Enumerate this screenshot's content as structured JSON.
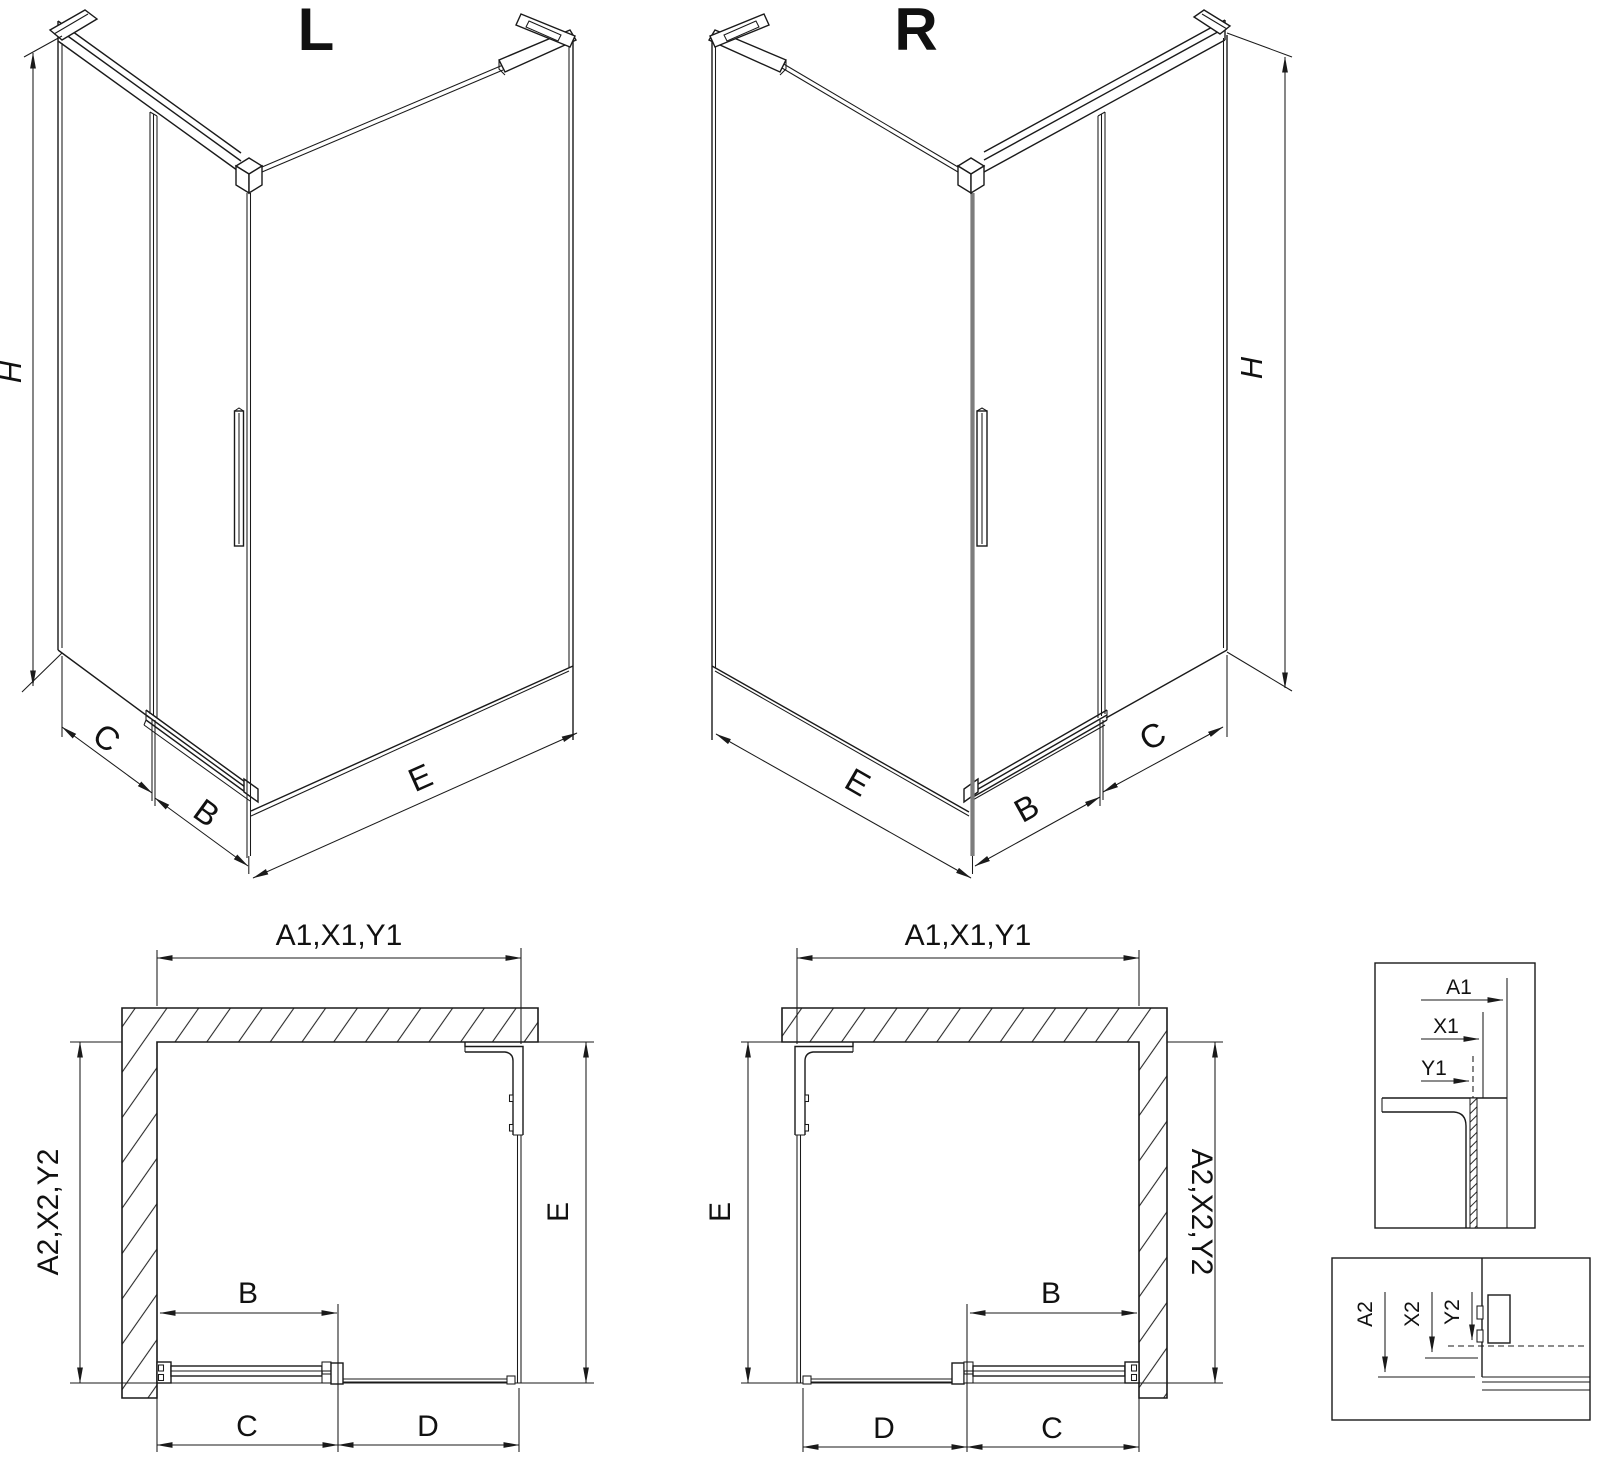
{
  "colors": {
    "line": "#1a1a1a",
    "corner_gray": "#7d7d7d",
    "background": "#ffffff"
  },
  "iso_left": {
    "label": "L",
    "dim_h": "H",
    "dim_c": "C",
    "dim_b": "B",
    "dim_e": "E"
  },
  "iso_right": {
    "label": "R",
    "dim_h": "H",
    "dim_e": "E",
    "dim_b": "B",
    "dim_c": "C"
  },
  "plan_left": {
    "dim_top": "A1,X1,Y1",
    "dim_left": "A2,X2,Y2",
    "dim_right": "E",
    "dim_b": "B",
    "dim_c": "C",
    "dim_d": "D"
  },
  "plan_right": {
    "dim_top": "A1,X1,Y1",
    "dim_left": "E",
    "dim_right": "A2,X2,Y2",
    "dim_b": "B",
    "dim_d": "D",
    "dim_c": "C"
  },
  "detail_top": {
    "dim_a1": "A1",
    "dim_x1": "X1",
    "dim_y1": "Y1"
  },
  "detail_bottom": {
    "dim_a2": "A2",
    "dim_x2": "X2",
    "dim_y2": "Y2"
  }
}
